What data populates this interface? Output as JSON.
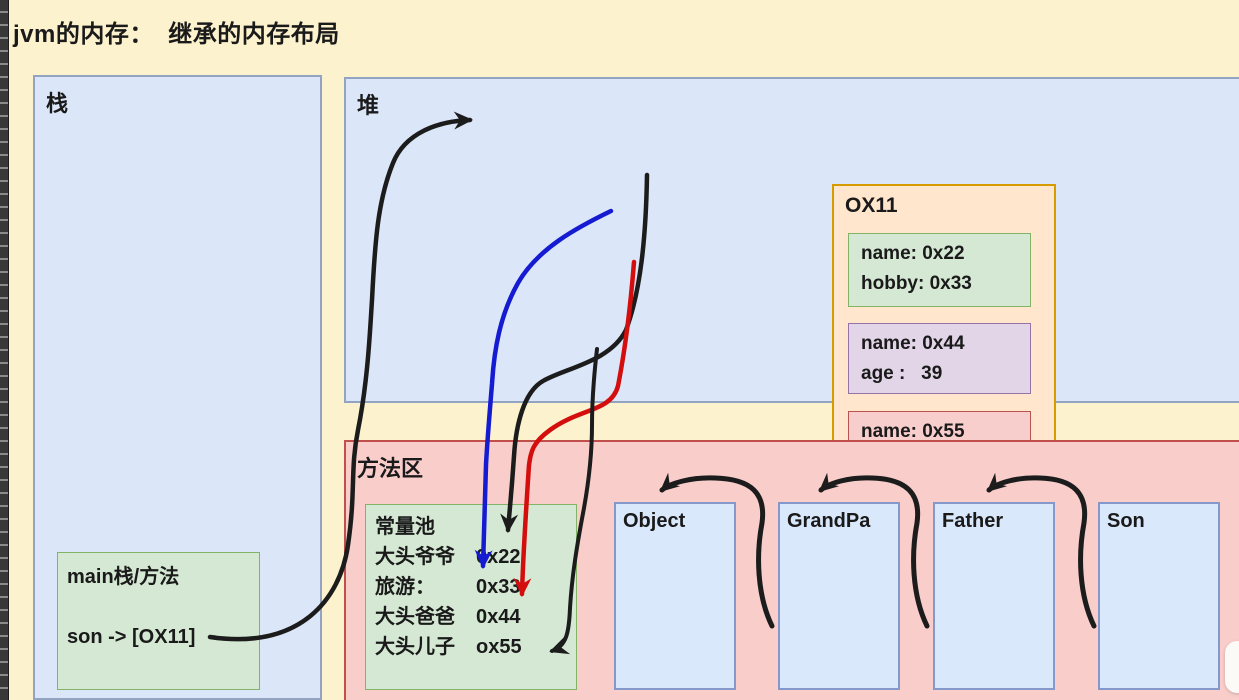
{
  "title": "jvm的内存：  继承的内存布局",
  "colors": {
    "canvas": "#fcf2cd",
    "region_blue_fill": "#dbe6f9",
    "region_pink_fill": "#f8cdca",
    "box_green_fill": "#d5e8d4",
    "box_purple_fill": "#e1d5e7",
    "box_orange_fill": "#ffe6cc",
    "box_red_fill": "#f8cecc",
    "arrow_black": "#1c1c1c",
    "arrow_blue": "#141bd1",
    "arrow_red": "#d40d0d"
  },
  "stack": {
    "label": "栈",
    "frame": {
      "line1": "main栈/方法",
      "line2": "son -> [OX11]"
    }
  },
  "heap": {
    "label": "堆",
    "object": {
      "address": "OX11",
      "son_fields": [
        "name: 0x22",
        "hobby: 0x33"
      ],
      "father_fields": [
        "name: 0x44",
        "age :   39"
      ],
      "grandpa_fields": [
        "name: 0x55"
      ]
    }
  },
  "method_area": {
    "label": "方法区",
    "constant_pool": {
      "title": "常量池",
      "entries": [
        {
          "label": "大头爷爷",
          "value": "0x22"
        },
        {
          "label": "旅游：",
          "value": "0x33"
        },
        {
          "label": "大头爸爸",
          "value": "0x44"
        },
        {
          "label": "大头儿子",
          "value": "ox55"
        }
      ]
    },
    "classes": [
      "Object",
      "GrandPa",
      "Father",
      "Son"
    ]
  },
  "arrows": [
    {
      "id": "son-var-to-ox11",
      "color": "black",
      "from": "son -> [OX11]",
      "to": "OX11"
    },
    {
      "id": "name22-to-pool",
      "color": "black",
      "from": "name: 0x22",
      "to": "0x22"
    },
    {
      "id": "hobby33-to-pool",
      "color": "blue",
      "from": "hobby: 0x33",
      "to": "0x33"
    },
    {
      "id": "name44-to-pool",
      "color": "red",
      "from": "name: 0x44",
      "to": "0x44"
    },
    {
      "id": "name55-to-pool",
      "color": "black",
      "from": "name: 0x55",
      "to": "ox55"
    },
    {
      "id": "grandpa-to-object",
      "color": "black",
      "from": "GrandPa",
      "to": "Object"
    },
    {
      "id": "father-to-grandpa",
      "color": "black",
      "from": "Father",
      "to": "GrandPa"
    },
    {
      "id": "son-to-father",
      "color": "black",
      "from": "Son",
      "to": "Father"
    }
  ]
}
